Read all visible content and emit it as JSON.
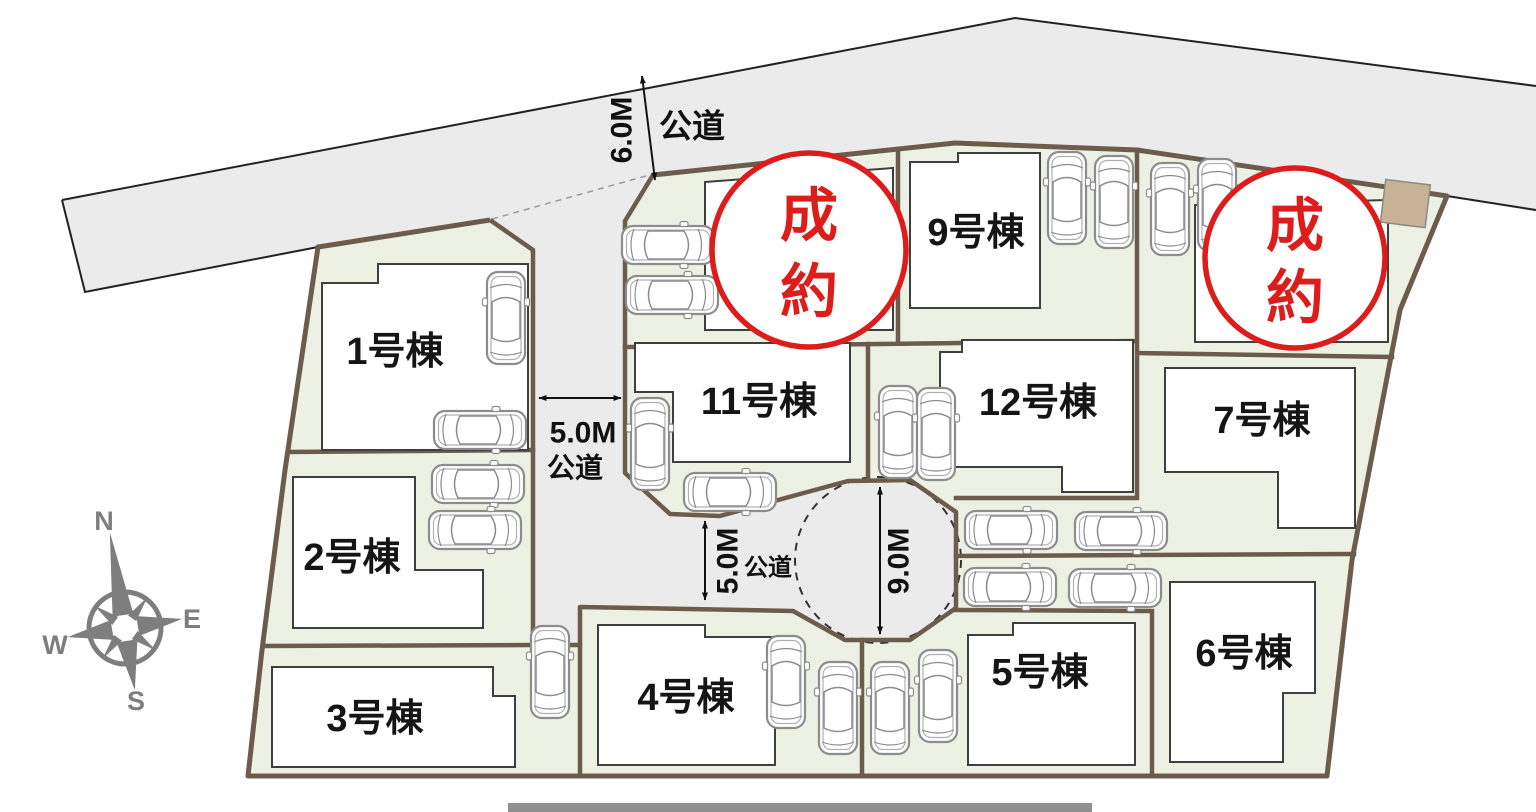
{
  "title": "分譲地区画図",
  "lots": {
    "lot1": {
      "label": "1号棟"
    },
    "lot2": {
      "label": "2号棟"
    },
    "lot3": {
      "label": "3号棟"
    },
    "lot4": {
      "label": "4号棟"
    },
    "lot5": {
      "label": "5号棟"
    },
    "lot6": {
      "label": "6号棟"
    },
    "lot7": {
      "label": "7号棟"
    },
    "lot9": {
      "label": "9号棟"
    },
    "lot11": {
      "label": "11号棟"
    },
    "lot12": {
      "label": "12号棟"
    }
  },
  "sold_badge": {
    "char1": "成",
    "char2": "約"
  },
  "roads": {
    "top": {
      "width": "6.0M",
      "name": "公道"
    },
    "west": {
      "width": "5.0M",
      "name": "公道"
    },
    "south": {
      "width": "5.0M",
      "name": "公道"
    },
    "culdesac_width": "9.0M"
  },
  "compass": {
    "north": "N",
    "east": "E",
    "south": "S",
    "west": "W"
  },
  "colors": {
    "lot_fill": "#edf1e4",
    "road_fill": "#ebebec",
    "boundary": "#6b5c4c",
    "building_stroke": "#3f3f3f",
    "sold_red": "#dd1c1c",
    "tan_shed": "#c8b295"
  }
}
